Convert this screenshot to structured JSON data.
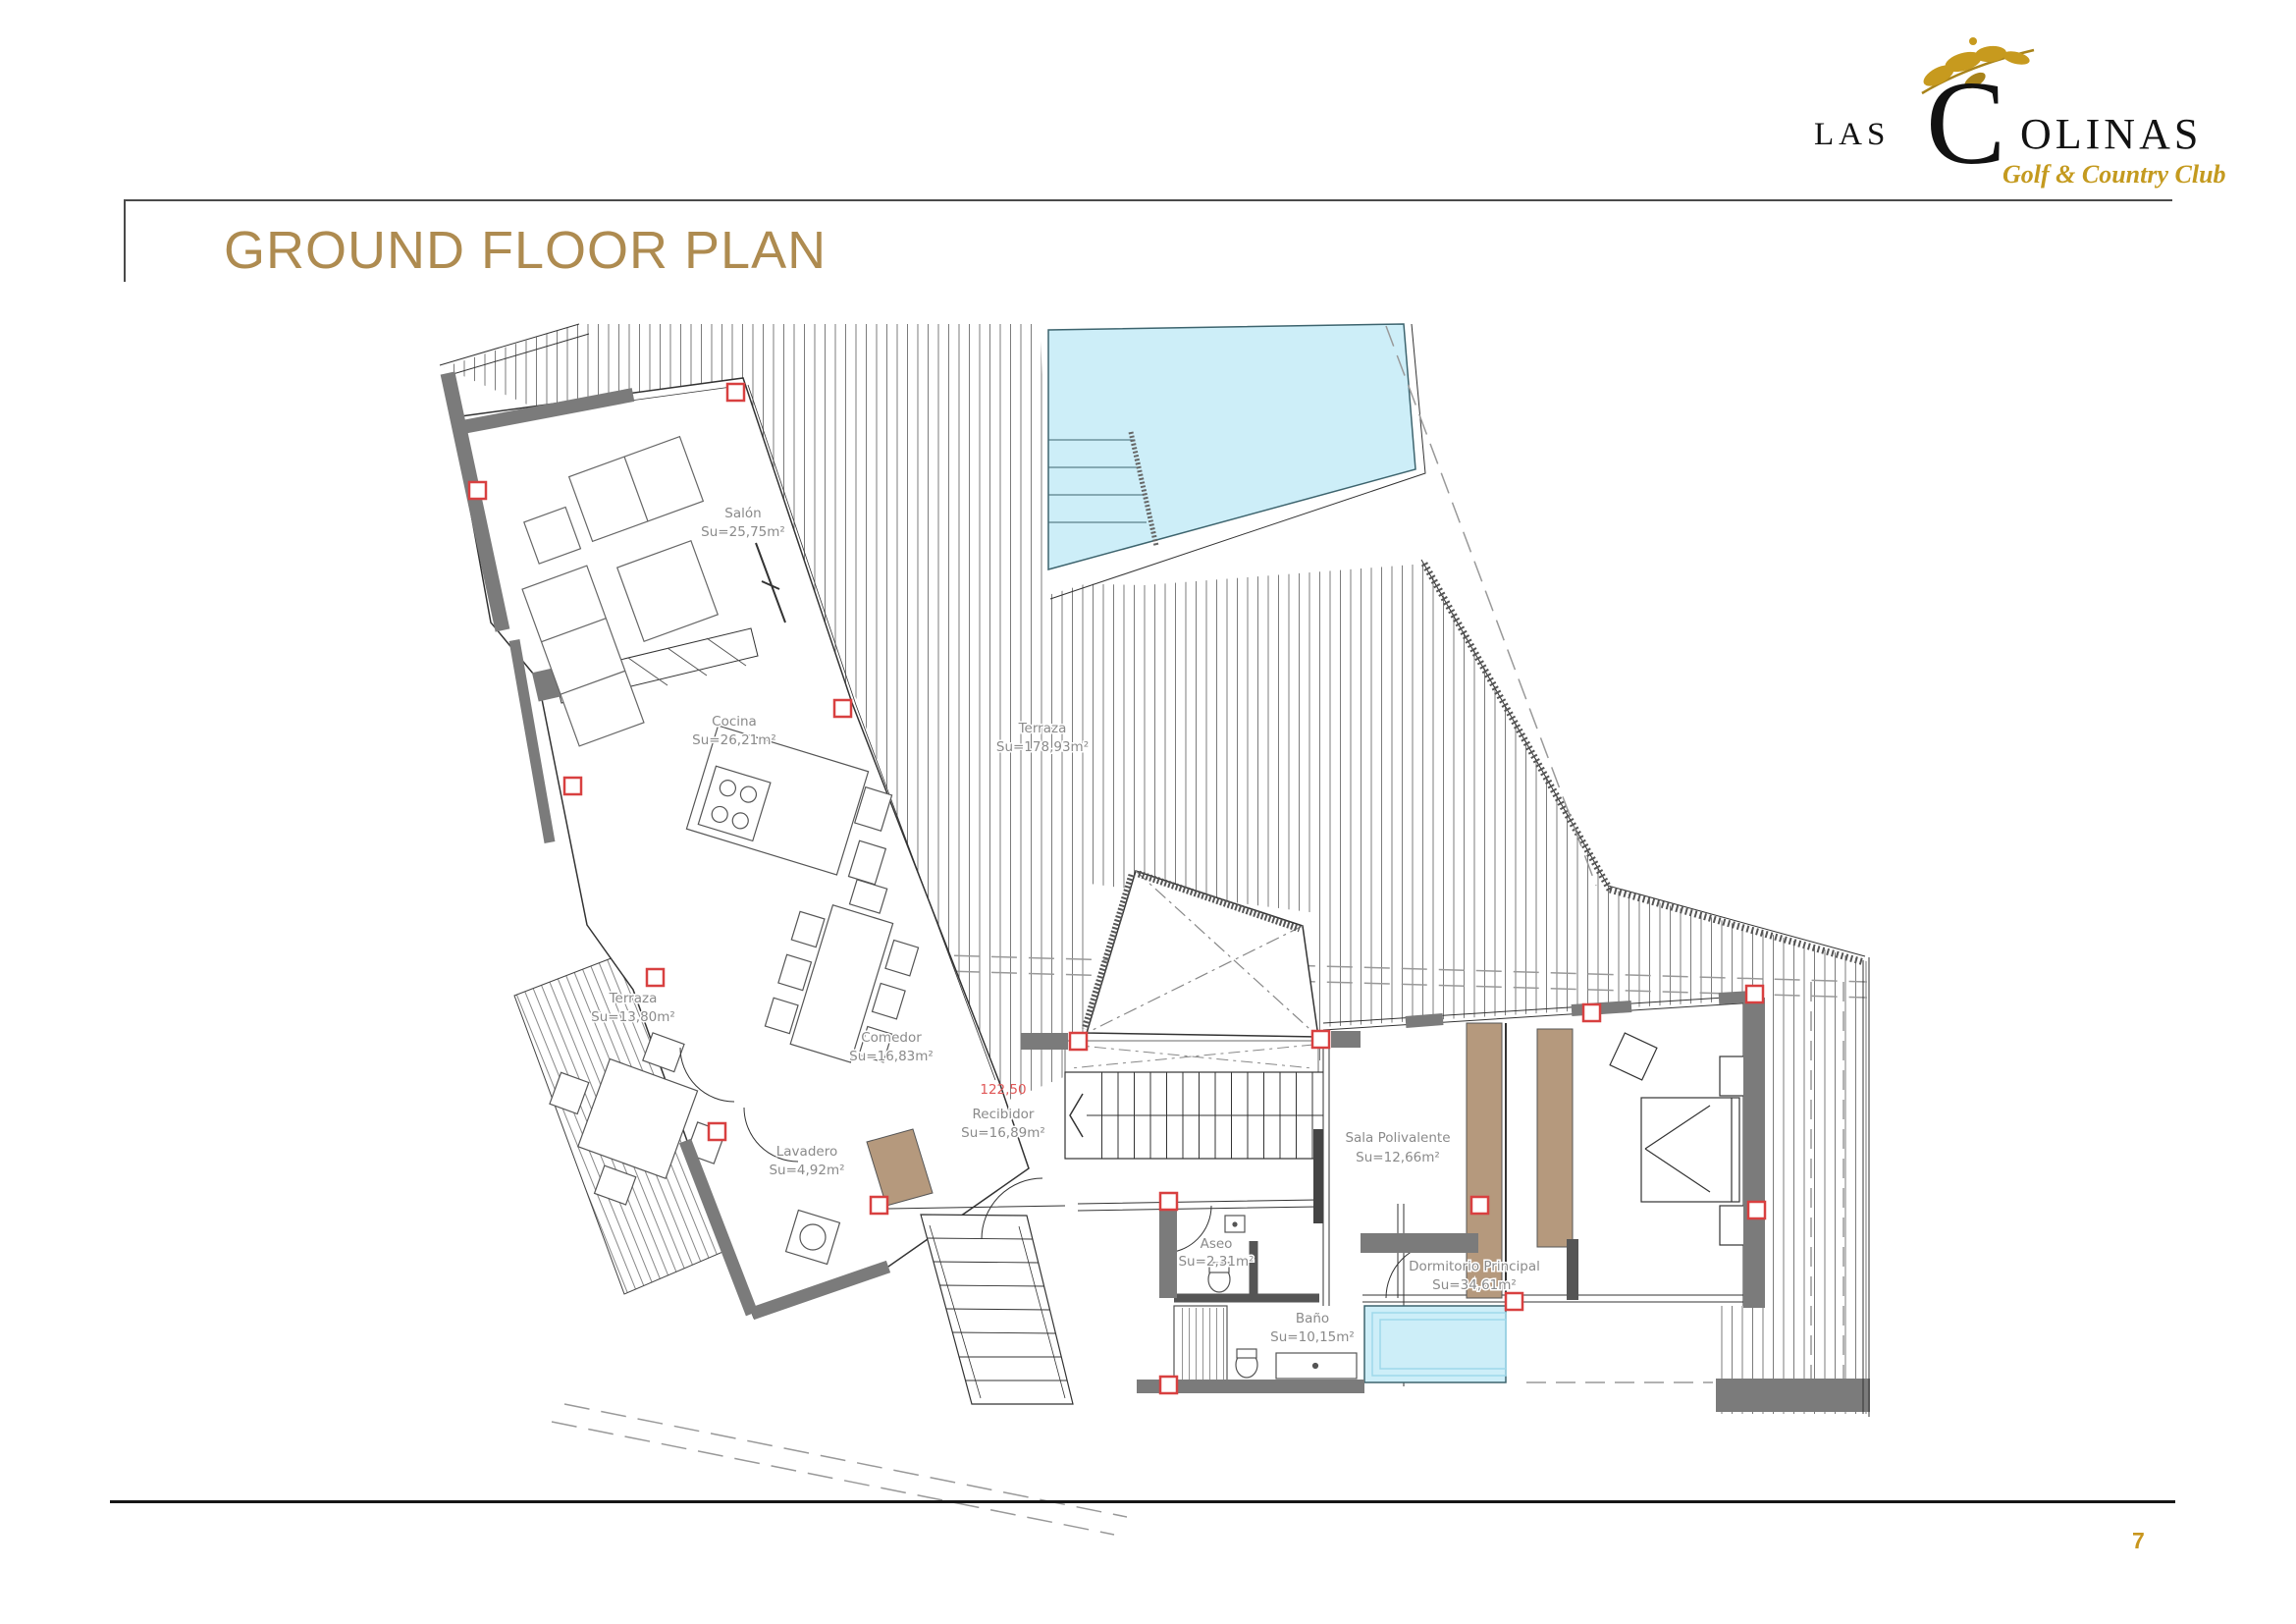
{
  "page": {
    "title": "GROUND FLOOR PLAN",
    "page_number": "7"
  },
  "logo": {
    "las": "LAS",
    "c": "C",
    "olinas": "OLINAS",
    "subtitle": "Golf & Country Club"
  },
  "colors": {
    "title_gold": "#ae8b50",
    "logo_gold": "#c49a1f",
    "label_gray": "#8a8a8a",
    "level_red": "#e05858",
    "wall_gray": "#7b7b7b",
    "pool_blue": "#cdeef8",
    "wood_tan": "#b5997d",
    "marker_red": "#d84040"
  },
  "plan": {
    "level_mark": "122,50",
    "rooms": [
      {
        "id": "salon",
        "name": "Salón",
        "area": "Su=25,75m²"
      },
      {
        "id": "cocina",
        "name": "Cocina",
        "area": "Su=26,21m²"
      },
      {
        "id": "terraza_main",
        "name": "Terraza",
        "area": "Su=178,93m²"
      },
      {
        "id": "terraza_small",
        "name": "Terraza",
        "area": "Su=13,80m²"
      },
      {
        "id": "comedor",
        "name": "Comedor",
        "area": "Su=16,83m²"
      },
      {
        "id": "recibidor",
        "name": "Recibidor",
        "area": "Su=16,89m²"
      },
      {
        "id": "lavadero",
        "name": "Lavadero",
        "area": "Su=4,92m²"
      },
      {
        "id": "sala_polivalente",
        "name": "Sala Polivalente",
        "area": "Su=12,66m²"
      },
      {
        "id": "aseo",
        "name": "Aseo",
        "area": "Su=2,31m²"
      },
      {
        "id": "bano",
        "name": "Baño",
        "area": "Su=10,15m²"
      },
      {
        "id": "dormitorio",
        "name": "Dormitorio Principal",
        "area": "Su=34,61m²"
      }
    ]
  }
}
